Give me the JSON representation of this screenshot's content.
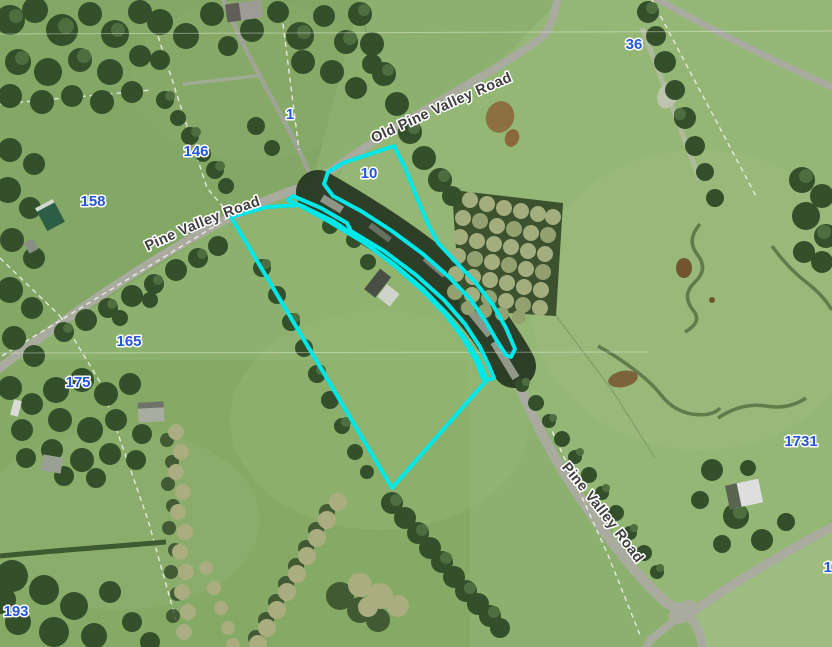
{
  "map": {
    "type": "aerial-imagery-with-cadastre",
    "highlight_color": "#00e7e7",
    "parcel_label_color": "#2356d8",
    "road_label_color": "#3e3e3e",
    "parcel_labels": [
      {
        "text": "1"
      },
      {
        "text": "36"
      },
      {
        "text": "146"
      },
      {
        "text": "158"
      },
      {
        "text": "10"
      },
      {
        "text": "165"
      },
      {
        "text": "175"
      },
      {
        "text": "193"
      },
      {
        "text": "1731"
      },
      {
        "text": "17"
      }
    ],
    "road_labels": [
      {
        "text": "Pine Valley Road"
      },
      {
        "text": "Old Pine Valley Road"
      },
      {
        "text": "Pine Valley Road"
      }
    ],
    "highlighted_parcels": [
      {
        "name": "north-road-strip-parcel-10"
      },
      {
        "name": "south-road-strip"
      },
      {
        "name": "main-selected-parcel"
      }
    ]
  }
}
